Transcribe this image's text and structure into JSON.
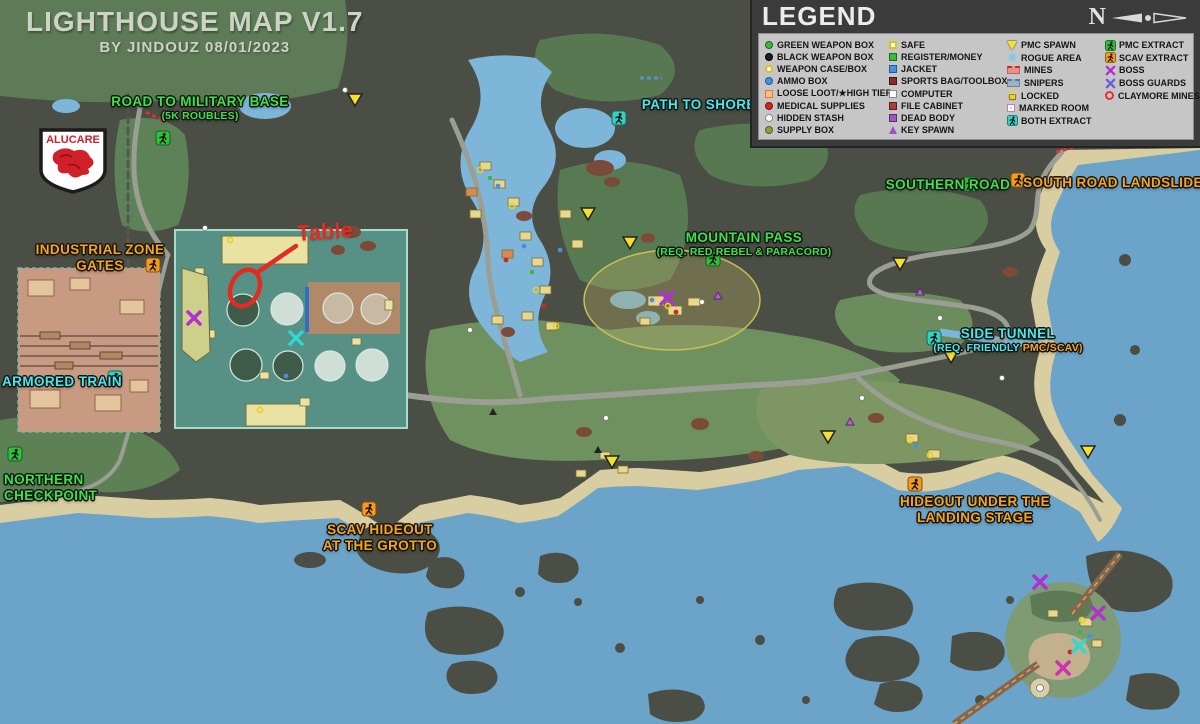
{
  "title": {
    "main": "LIGHTHOUSE MAP V1.7",
    "byline": "BY JINDOUZ 08/01/2023"
  },
  "logo": {
    "text": "ALUCARE"
  },
  "compass": {
    "label": "N"
  },
  "legend": {
    "title": "LEGEND",
    "c1": [
      "GREEN WEAPON BOX",
      "BLACK WEAPON BOX",
      "WEAPON CASE/BOX",
      "AMMO BOX",
      "LOOSE LOOT/★HIGH TIER",
      "MEDICAL SUPPLIES",
      "HIDDEN STASH",
      "SUPPLY BOX"
    ],
    "c2": [
      "SAFE",
      "REGISTER/MONEY",
      "JACKET",
      "SPORTS BAG/TOOLBOX",
      "COMPUTER",
      "FILE CABINET",
      "DEAD BODY",
      "KEY SPAWN"
    ],
    "c3": [
      "PMC SPAWN",
      "ROGUE AREA",
      "MINES",
      "SNIPERS",
      "LOCKED",
      "MARKED ROOM",
      "BOTH EXTRACT"
    ],
    "c4": [
      "PMC EXTRACT",
      "SCAV EXTRACT",
      "BOSS",
      "BOSS GUARDS",
      "CLAYMORE MINES"
    ]
  },
  "labels": {
    "military_base": {
      "text": "ROAD TO MILITARY BASE",
      "sub": "(5K ROUBLES)"
    },
    "shoreline": {
      "text": "PATH TO SHORELINE"
    },
    "southern_road": {
      "text": "SOUTHERN ROAD"
    },
    "landslide": {
      "text": "SOUTH ROAD LANDSLIDE"
    },
    "mountain_pass": {
      "text": "MOUNTAIN PASS",
      "sub": "(REQ. RED REBEL & PARACORD)"
    },
    "side_tunnel": {
      "text": "SIDE TUNNEL",
      "sub_a": "(REQ. FRIENDLY ",
      "sub_b": "PMC/SCAV)"
    },
    "industrial": {
      "line1": "INDUSTRIAL ZONE",
      "line2": "GATES"
    },
    "armored_train": {
      "text": "ARMORED TRAIN"
    },
    "northern_checkpoint": {
      "line1": "NORTHERN",
      "line2": "CHECKPOINT"
    },
    "grotto": {
      "line1": "SCAV HIDEOUT",
      "line2": "AT THE GROTTO"
    },
    "landing_stage": {
      "line1": "HIDEOUT UNDER THE",
      "line2": "LANDING STAGE"
    },
    "annotation": {
      "text": "Table"
    }
  },
  "colors": {
    "water": "#6ba3c9",
    "rock": "#4a4e44",
    "sand": "#d9cda2",
    "label_green": "#3fe04a",
    "label_cyan": "#49e8e8",
    "label_orange": "#f6a51f",
    "annotation_red": "#e32b22",
    "extract_green": "#2fbf3a",
    "extract_teal": "#35d0c0",
    "extract_orange": "#f59a20",
    "boss_x": "#b030d0",
    "guard_x": "#6a5ae0"
  }
}
